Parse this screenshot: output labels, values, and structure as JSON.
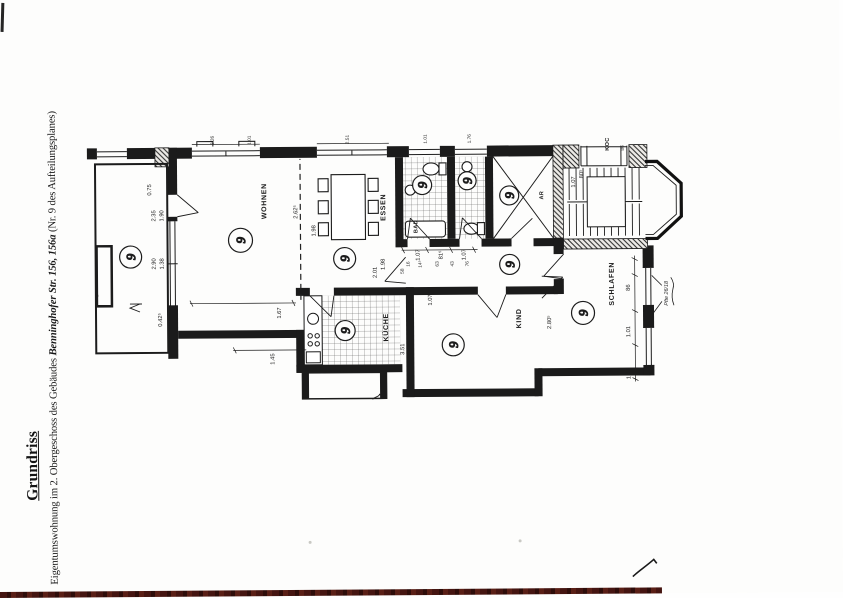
{
  "document": {
    "title": "Grundriss",
    "subtitle_prefix": "Eigentumswohnung im 2. Obergeschoss des Gebäudes",
    "subtitle_address": "Benninghofer Str. 156, 156a",
    "subtitle_suffix": "(Nr. 9 des Aufteilungsplanes)"
  },
  "floorplan": {
    "unit_number": "9",
    "rooms": {
      "wohnen": "WOHNEN",
      "essen": "ESSEN",
      "kueche": "KÜCHE",
      "bad": "BAD",
      "kind": "KIND",
      "schlafen": "SCHLAFEN",
      "abstellraum": "AR",
      "neighbor_partial": "KOC"
    },
    "dims": {
      "balcony_rail": "0.75",
      "balcony_door_a": "2.35",
      "balcony_door_b": "1.90",
      "window_a": "2.90",
      "window_b": "1.38",
      "corner": "0.42⁵",
      "wohnen_side": "1.67",
      "exterior_side": "1.45",
      "essen_table": "1.98",
      "essen_door_a": "2.01",
      "essen_door_b": "1.98",
      "open_width": "2.62⁵",
      "hall_a": "1.07",
      "hall_b": "81⁵",
      "hall_c": "1.07",
      "hall_t1": "16",
      "hall_t2": "14⁵",
      "hall_t3": "63",
      "hall_t4": "43",
      "hall_t5": "76",
      "hall_width": "58",
      "kind_door": "1.07",
      "kind_width": "3.51",
      "kind_wall": "2.80⁵",
      "schlafen_win_a": "86",
      "schlafen_win_b": "1.01",
      "schlafen_win_c": "1.01",
      "stair_a": "1.07",
      "stair_b": "80⁵",
      "outer_a": "2.26",
      "outer_b": "1.01",
      "outer_c": "2.51",
      "outer_d": "1.01",
      "outer_e": "1.76",
      "neighbor_dim": "86"
    },
    "annotation": "Pfte 26/18"
  },
  "colors": {
    "edge_strip": "#451511",
    "ink": "#1c1c1c"
  }
}
